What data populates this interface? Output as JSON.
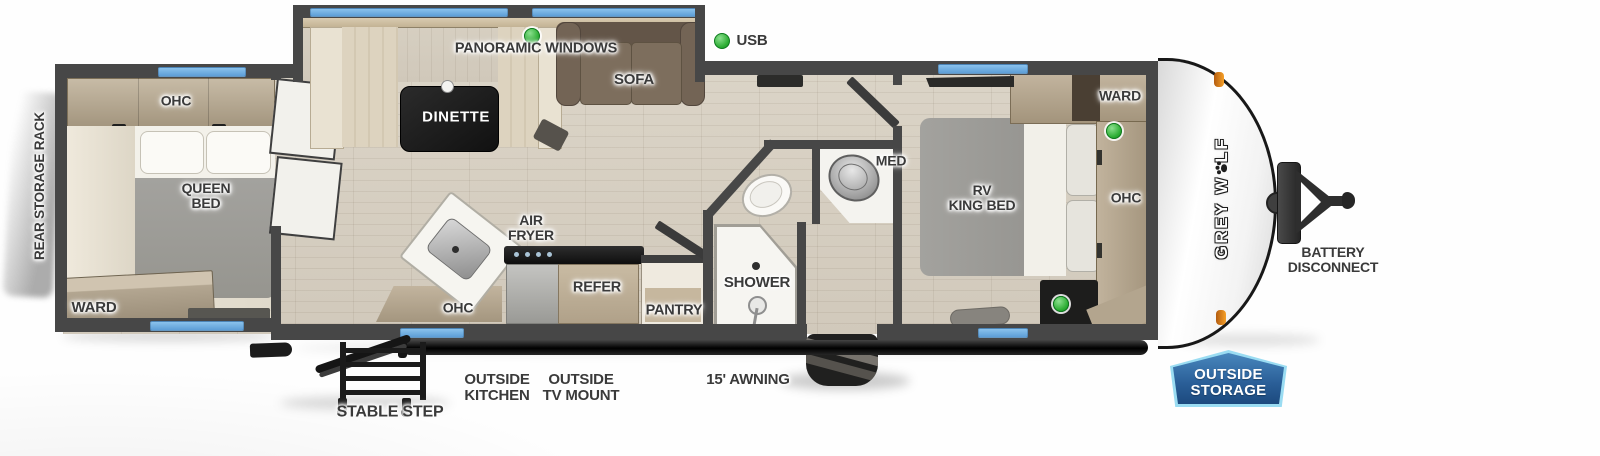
{
  "floorplan": {
    "colors": {
      "window_blue": "#6fb0e4",
      "feature_green": "#2eae35",
      "cabinet_tan": "#b9ab96",
      "sofa_brown": "#6e6052",
      "wall_gray": "#474747",
      "marker_orange": "#f29422",
      "badge_blue": "#2a5e97",
      "badge_border": "#9adcf2"
    },
    "exterior": {
      "rear_storage_rack": "REAR STORAGE RACK",
      "stable_step": "STABLE STEP",
      "outside_kitchen": "OUTSIDE\nKITCHEN",
      "outside_tv_mount": "OUTSIDE\nTV MOUNT",
      "awning": "15' AWNING",
      "battery_disconnect": "BATTERY\nDISCONNECT",
      "outside_storage": "OUTSIDE\nSTORAGE",
      "brand_part1": "GREY W",
      "brand_part2": "LF"
    },
    "rear_bedroom": {
      "ohc": "OHC",
      "bed": "QUEEN\nBED",
      "ward": "WARD"
    },
    "living": {
      "panoramic_windows": "PANORAMIC WINDOWS",
      "dinette": "DINETTE",
      "sofa": "SOFA",
      "usb": "USB"
    },
    "kitchen": {
      "air_fryer": "AIR\nFRYER",
      "ohc": "OHC",
      "refer": "REFER",
      "pantry": "PANTRY"
    },
    "bathroom": {
      "shower": "SHOWER",
      "med": "MED"
    },
    "front_bedroom": {
      "bed": "RV\nKING BED",
      "ward": "WARD",
      "ohc": "OHC"
    }
  }
}
